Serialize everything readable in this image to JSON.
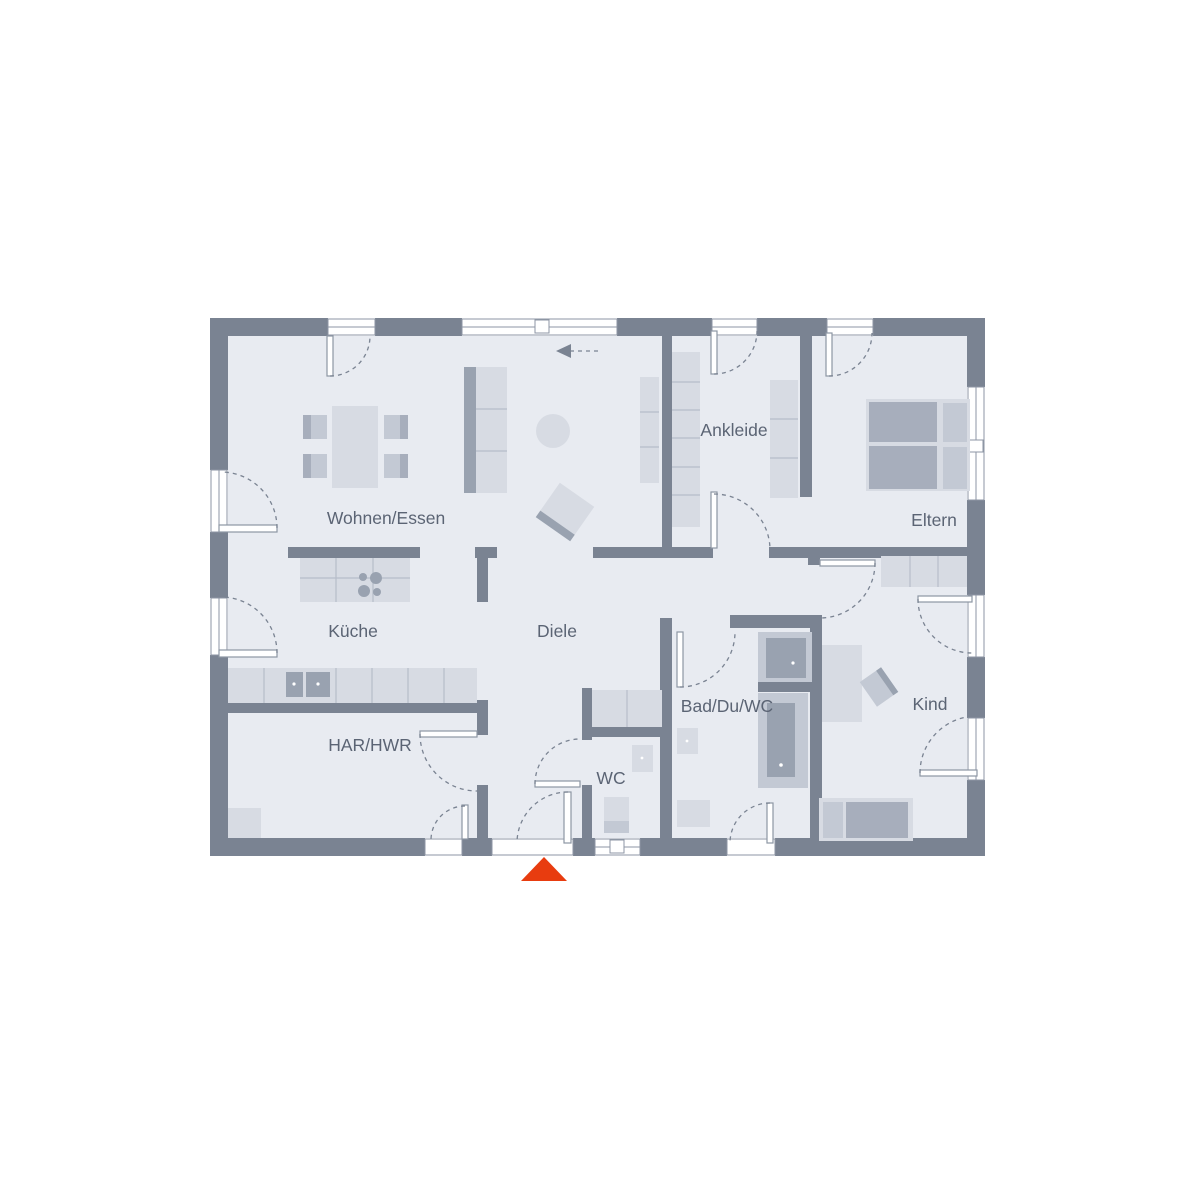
{
  "title": "Grundriss Bungalow",
  "rooms": [
    {
      "id": "wohnen-essen",
      "label": "Wohnen/Essen"
    },
    {
      "id": "kueche",
      "label": "Küche"
    },
    {
      "id": "diele",
      "label": "Diele"
    },
    {
      "id": "ankleide",
      "label": "Ankleide"
    },
    {
      "id": "eltern",
      "label": "Eltern"
    },
    {
      "id": "har-hwr",
      "label": "HAR/HWR"
    },
    {
      "id": "wc",
      "label": "WC"
    },
    {
      "id": "bad-du-wc",
      "label": "Bad/Du/WC"
    },
    {
      "id": "kind",
      "label": "Kind"
    }
  ],
  "icons": {
    "entrance_marker": "entrance-arrow",
    "sliding_door_arrow": "slide-direction-left"
  },
  "colors": {
    "background": "#ffffff",
    "wall": "#7a8392",
    "floor": "#e8ebf1",
    "furniture_light": "#d7dbe3",
    "furniture_mid": "#c3c9d4",
    "furniture_dark": "#a7aebc",
    "fixture": "#99a2b0",
    "furniture_line": "#b6bdc9",
    "frame": "#8d96a4",
    "arc": "#7a8392",
    "label": "#5b6474",
    "accent": "#e83c0f"
  }
}
